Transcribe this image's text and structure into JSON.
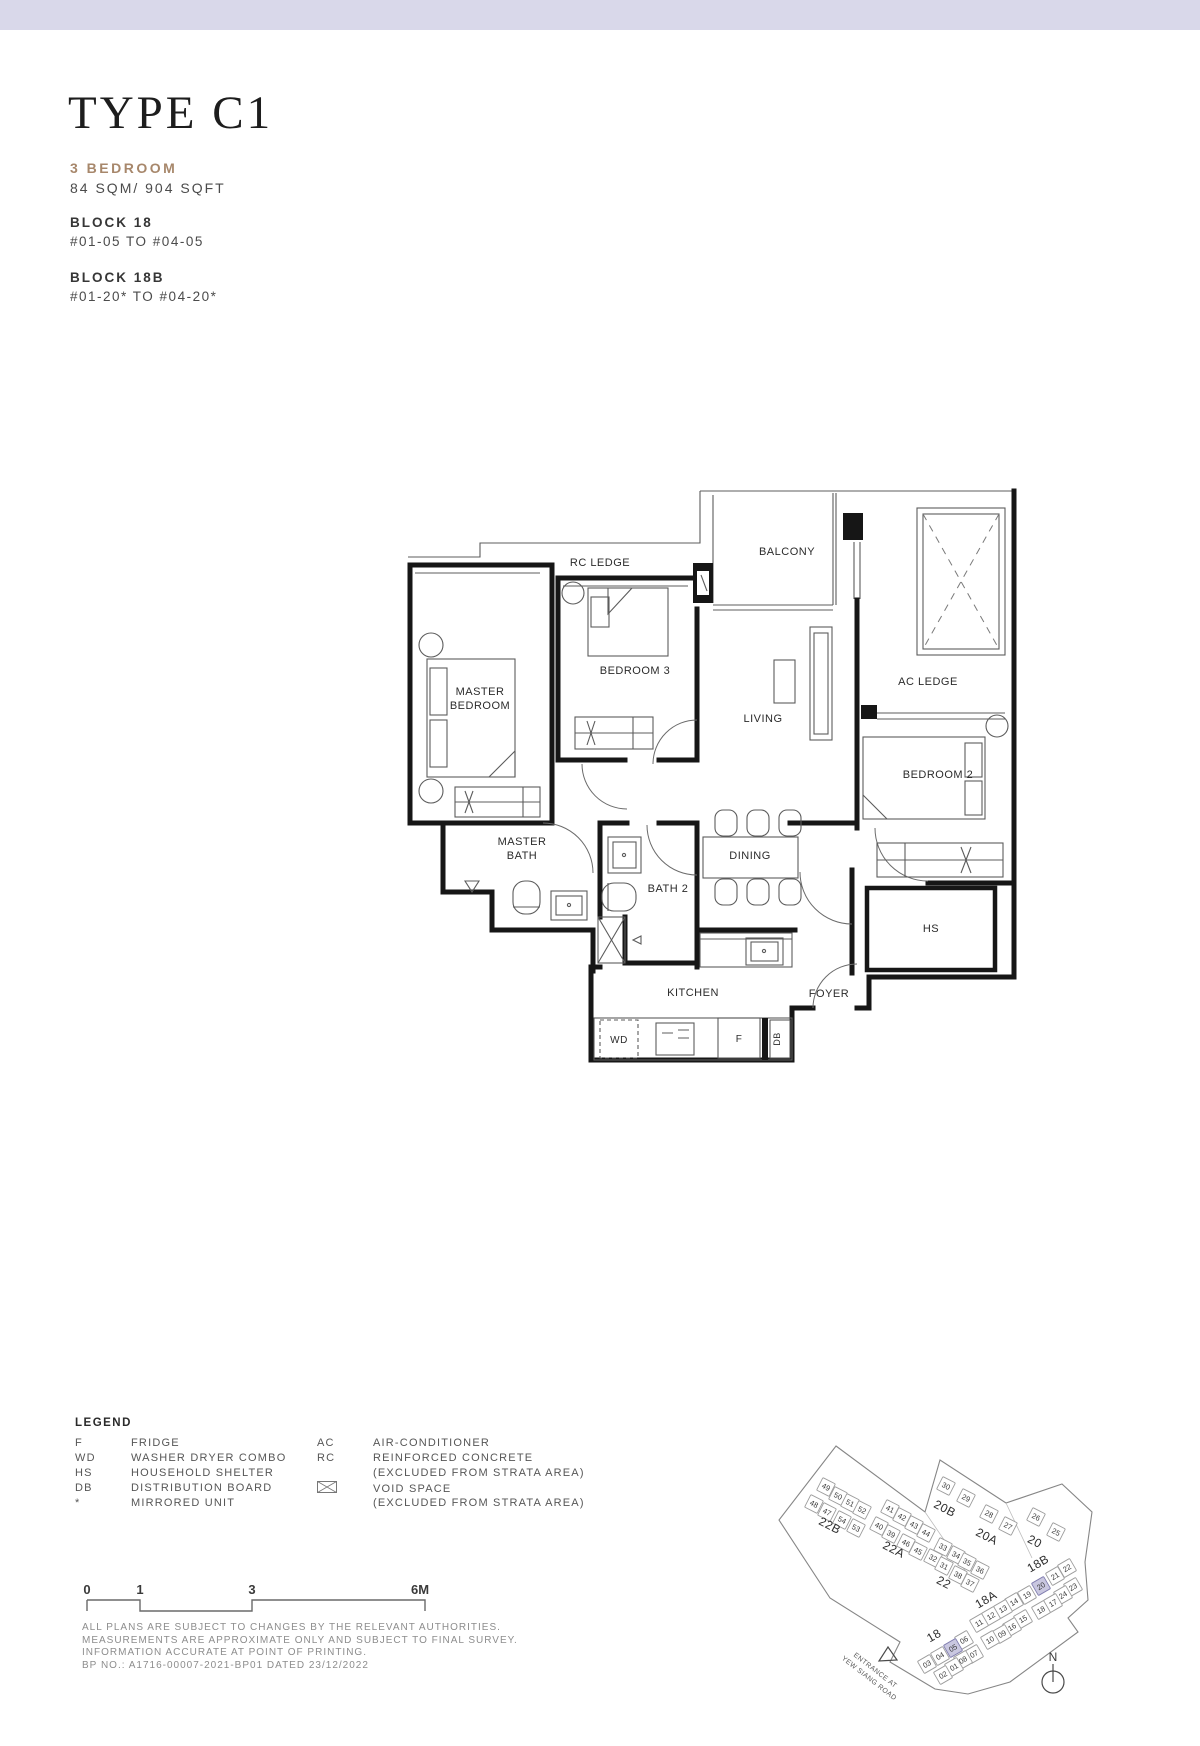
{
  "header": {
    "title": "TYPE C1",
    "unit_type": "3 BEDROOM",
    "area": "84 SQM/ 904 SQFT",
    "blocks": [
      {
        "name": "BLOCK 18",
        "floors": "#01-05 TO #04-05"
      },
      {
        "name": "BLOCK 18B",
        "floors": "#01-20* TO #04-20*"
      }
    ]
  },
  "colors": {
    "accent_bar": "#d9d8ea",
    "unit_type_color": "#a7876b",
    "site_highlight": "#c9c7e0"
  },
  "floorplan": {
    "labels": [
      {
        "id": "rc-ledge",
        "text": "RC LEDGE",
        "x": 195,
        "y": 79
      },
      {
        "id": "balcony",
        "text": "BALCONY",
        "x": 382,
        "y": 68
      },
      {
        "id": "master-bedroom",
        "lines": [
          "MASTER",
          "BEDROOM"
        ],
        "x": 75,
        "y": 208
      },
      {
        "id": "bedroom-3",
        "text": "BEDROOM 3",
        "x": 230,
        "y": 187
      },
      {
        "id": "living",
        "text": "LIVING",
        "x": 358,
        "y": 235
      },
      {
        "id": "ac-ledge",
        "text": "AC LEDGE",
        "x": 523,
        "y": 198
      },
      {
        "id": "bedroom-2",
        "text": "BEDROOM 2",
        "x": 533,
        "y": 291
      },
      {
        "id": "master-bath",
        "lines": [
          "MASTER",
          "BATH"
        ],
        "x": 117,
        "y": 358
      },
      {
        "id": "bath-2",
        "text": "BATH 2",
        "x": 263,
        "y": 405
      },
      {
        "id": "dining",
        "text": "DINING",
        "x": 345,
        "y": 372
      },
      {
        "id": "hs",
        "text": "HS",
        "x": 526,
        "y": 445
      },
      {
        "id": "kitchen",
        "text": "KITCHEN",
        "x": 288,
        "y": 509
      },
      {
        "id": "foyer",
        "text": "FOYER",
        "x": 424,
        "y": 510
      },
      {
        "id": "wd",
        "text": "WD",
        "x": 214,
        "y": 556,
        "fs": 10
      },
      {
        "id": "fridge",
        "text": "F",
        "x": 334,
        "y": 555,
        "fs": 10
      },
      {
        "id": "db",
        "text": "DB",
        "x": 375,
        "y": 552,
        "fs": 9,
        "rot": -90
      }
    ]
  },
  "legend": {
    "title": "LEGEND",
    "col1": [
      {
        "abbr": "F",
        "desc": "FRIDGE"
      },
      {
        "abbr": "WD",
        "desc": "WASHER DRYER COMBO"
      },
      {
        "abbr": "HS",
        "desc": "HOUSEHOLD SHELTER"
      },
      {
        "abbr": "DB",
        "desc": "DISTRIBUTION BOARD"
      },
      {
        "abbr": "*",
        "desc": "MIRRORED UNIT"
      }
    ],
    "col2": [
      {
        "abbr": "AC",
        "desc": "AIR-CONDITIONER"
      },
      {
        "abbr": "RC",
        "desc": "REINFORCED CONCRETE"
      },
      {
        "abbr": "",
        "desc": "(EXCLUDED FROM STRATA AREA)"
      },
      {
        "abbr": "icon",
        "desc": "VOID SPACE"
      },
      {
        "abbr": "",
        "desc": "(EXCLUDED FROM STRATA AREA)"
      }
    ]
  },
  "scalebar": {
    "labels": [
      {
        "text": "0",
        "x": 87
      },
      {
        "text": "1",
        "x": 140
      },
      {
        "text": "3",
        "x": 252
      },
      {
        "text": "6M",
        "x": 420
      }
    ]
  },
  "disclaimer": {
    "lines": [
      "ALL PLANS ARE SUBJECT TO CHANGES BY THE RELEVANT AUTHORITIES.",
      "MEASUREMENTS ARE APPROXIMATE ONLY AND SUBJECT TO FINAL SURVEY.",
      "INFORMATION ACCURATE AT POINT OF PRINTING.",
      "BP NO.: A1716-00007-2021-BP01 DATED 23/12/2022"
    ]
  },
  "siteplan": {
    "north_label": "N",
    "entrance_lines": [
      "ENTRANCE AT",
      "YEW SIANG ROAD"
    ],
    "blocks": [
      {
        "name": "22B",
        "x": 828,
        "y": 1529,
        "rot": 27
      },
      {
        "name": "22A",
        "x": 892,
        "y": 1553,
        "rot": 27
      },
      {
        "name": "22",
        "x": 942,
        "y": 1586,
        "rot": 27
      },
      {
        "name": "20B",
        "x": 943,
        "y": 1512,
        "rot": 27
      },
      {
        "name": "20A",
        "x": 985,
        "y": 1540,
        "rot": 27
      },
      {
        "name": "20",
        "x": 1033,
        "y": 1545,
        "rot": 27
      },
      {
        "name": "18B",
        "x": 1040,
        "y": 1567,
        "rot": -30
      },
      {
        "name": "18A",
        "x": 988,
        "y": 1603,
        "rot": -30
      },
      {
        "name": "18",
        "x": 936,
        "y": 1639,
        "rot": -30
      }
    ],
    "units": [
      {
        "n": "49",
        "x": 826,
        "y": 1487,
        "rot": 27
      },
      {
        "n": "50",
        "x": 838,
        "y": 1496,
        "rot": 27
      },
      {
        "n": "51",
        "x": 850,
        "y": 1503,
        "rot": 27
      },
      {
        "n": "52",
        "x": 862,
        "y": 1510,
        "rot": 27
      },
      {
        "n": "48",
        "x": 814,
        "y": 1504,
        "rot": 27
      },
      {
        "n": "47",
        "x": 827,
        "y": 1512,
        "rot": 27
      },
      {
        "n": "54",
        "x": 842,
        "y": 1520,
        "rot": 27
      },
      {
        "n": "53",
        "x": 856,
        "y": 1528,
        "rot": 27
      },
      {
        "n": "41",
        "x": 890,
        "y": 1509,
        "rot": 27
      },
      {
        "n": "42",
        "x": 902,
        "y": 1517,
        "rot": 27
      },
      {
        "n": "43",
        "x": 914,
        "y": 1525,
        "rot": 27
      },
      {
        "n": "44",
        "x": 926,
        "y": 1533,
        "rot": 27
      },
      {
        "n": "40",
        "x": 879,
        "y": 1526,
        "rot": 27
      },
      {
        "n": "39",
        "x": 891,
        "y": 1534,
        "rot": 27
      },
      {
        "n": "46",
        "x": 906,
        "y": 1543,
        "rot": 27
      },
      {
        "n": "45",
        "x": 918,
        "y": 1551,
        "rot": 27
      },
      {
        "n": "33",
        "x": 943,
        "y": 1547,
        "rot": 27
      },
      {
        "n": "34",
        "x": 956,
        "y": 1555,
        "rot": 27
      },
      {
        "n": "35",
        "x": 967,
        "y": 1562,
        "rot": 27
      },
      {
        "n": "36",
        "x": 980,
        "y": 1570,
        "rot": 27
      },
      {
        "n": "32",
        "x": 933,
        "y": 1558,
        "rot": 27
      },
      {
        "n": "31",
        "x": 944,
        "y": 1566,
        "rot": 27
      },
      {
        "n": "38",
        "x": 958,
        "y": 1575,
        "rot": 27
      },
      {
        "n": "37",
        "x": 970,
        "y": 1583,
        "rot": 27
      },
      {
        "n": "30",
        "x": 946,
        "y": 1486,
        "rot": 27
      },
      {
        "n": "29",
        "x": 966,
        "y": 1498,
        "rot": 27
      },
      {
        "n": "28",
        "x": 989,
        "y": 1514,
        "rot": 27
      },
      {
        "n": "27",
        "x": 1008,
        "y": 1526,
        "rot": 27
      },
      {
        "n": "26",
        "x": 1036,
        "y": 1517,
        "rot": 27
      },
      {
        "n": "25",
        "x": 1056,
        "y": 1532,
        "rot": 27
      },
      {
        "n": "22",
        "x": 1067,
        "y": 1568,
        "rot": -30
      },
      {
        "n": "21",
        "x": 1055,
        "y": 1576,
        "rot": -30
      },
      {
        "n": "20",
        "x": 1041,
        "y": 1586,
        "rot": -30,
        "hl": true
      },
      {
        "n": "19",
        "x": 1027,
        "y": 1595,
        "rot": -30
      },
      {
        "n": "23",
        "x": 1073,
        "y": 1587,
        "rot": -30
      },
      {
        "n": "24",
        "x": 1063,
        "y": 1595,
        "rot": -30
      },
      {
        "n": "17",
        "x": 1053,
        "y": 1603,
        "rot": -30
      },
      {
        "n": "18",
        "x": 1041,
        "y": 1610,
        "rot": -30
      },
      {
        "n": "14",
        "x": 1014,
        "y": 1602,
        "rot": -30
      },
      {
        "n": "13",
        "x": 1003,
        "y": 1609,
        "rot": -30
      },
      {
        "n": "12",
        "x": 991,
        "y": 1616,
        "rot": -30
      },
      {
        "n": "11",
        "x": 979,
        "y": 1623,
        "rot": -30
      },
      {
        "n": "15",
        "x": 1023,
        "y": 1619,
        "rot": -30
      },
      {
        "n": "16",
        "x": 1012,
        "y": 1627,
        "rot": -30
      },
      {
        "n": "09",
        "x": 1002,
        "y": 1634,
        "rot": -30
      },
      {
        "n": "10",
        "x": 990,
        "y": 1640,
        "rot": -30
      },
      {
        "n": "06",
        "x": 964,
        "y": 1640,
        "rot": -30
      },
      {
        "n": "05",
        "x": 953,
        "y": 1648,
        "rot": -30,
        "hl": true
      },
      {
        "n": "04",
        "x": 940,
        "y": 1656,
        "rot": -30
      },
      {
        "n": "03",
        "x": 927,
        "y": 1664,
        "rot": -30
      },
      {
        "n": "07",
        "x": 974,
        "y": 1654,
        "rot": -30
      },
      {
        "n": "08",
        "x": 963,
        "y": 1660,
        "rot": -30
      },
      {
        "n": "01",
        "x": 954,
        "y": 1667,
        "rot": -30
      },
      {
        "n": "02",
        "x": 943,
        "y": 1675,
        "rot": -30
      }
    ]
  }
}
